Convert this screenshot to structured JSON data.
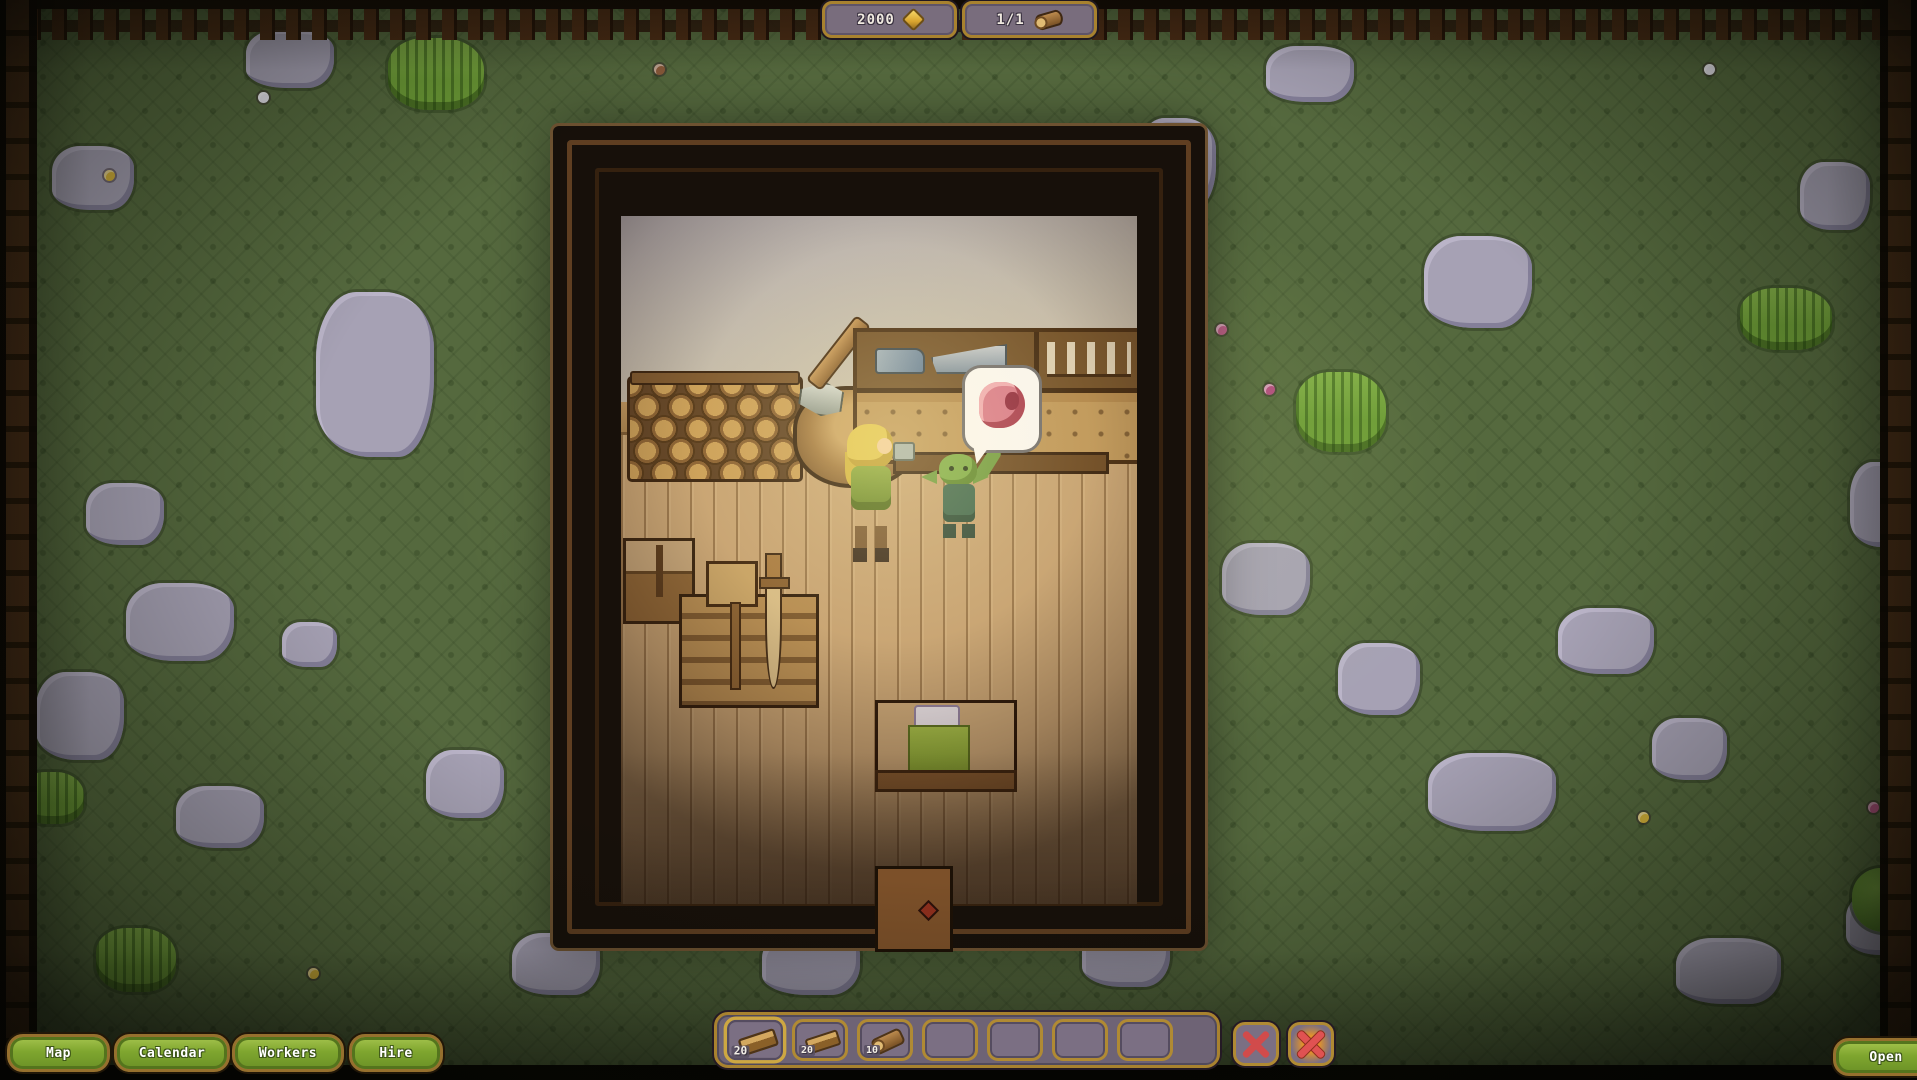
{
  "hud": {
    "money": {
      "value": "2000",
      "icon": "coin-icon"
    },
    "resource": {
      "value": "1/1",
      "icon": "log-icon"
    }
  },
  "menu": {
    "buttons": [
      {
        "label": "Map"
      },
      {
        "label": "Calendar"
      },
      {
        "label": "Workers"
      },
      {
        "label": "Hire"
      }
    ]
  },
  "open_button": {
    "label": "Open"
  },
  "hotbar": {
    "slots": [
      {
        "item": "plank",
        "count": "20",
        "selected": true
      },
      {
        "item": "plank",
        "count": "20"
      },
      {
        "item": "log",
        "count": "10"
      },
      {},
      {},
      {},
      {}
    ],
    "actions": [
      {
        "name": "cancel-slot-button",
        "icon": "red-x-icon"
      },
      {
        "name": "destroy-slot-button",
        "icon": "red-x-burst-icon"
      }
    ]
  },
  "scene": {
    "speech_bubble_icon": "meat-icon",
    "characters": [
      {
        "name": "villager"
      },
      {
        "name": "goblin"
      }
    ],
    "colors": {
      "grass": "#55693e",
      "stone": "#a6a1b4",
      "panel": "#796d7d",
      "gold_border": "#a8822f",
      "button_green": "#7fa62f",
      "x_red": "#d14b4b"
    },
    "decorations": {
      "stones": [
        [
          52,
          146,
          82,
          64
        ],
        [
          246,
          30,
          88,
          58
        ],
        [
          1138,
          118,
          78,
          92
        ],
        [
          1266,
          46,
          88,
          56
        ],
        [
          1424,
          236,
          108,
          92
        ],
        [
          1800,
          162,
          70,
          68
        ],
        [
          1850,
          462,
          66,
          85
        ],
        [
          952,
          438,
          95,
          82
        ],
        [
          1046,
          298,
          68,
          56
        ],
        [
          316,
          292,
          118,
          165
        ],
        [
          86,
          483,
          78,
          62
        ],
        [
          126,
          583,
          108,
          78
        ],
        [
          36,
          672,
          88,
          88
        ],
        [
          176,
          786,
          88,
          62
        ],
        [
          426,
          750,
          78,
          68
        ],
        [
          512,
          933,
          88,
          62
        ],
        [
          762,
          933,
          98,
          62
        ],
        [
          1082,
          923,
          88,
          64
        ],
        [
          1222,
          543,
          88,
          72
        ],
        [
          1338,
          643,
          82,
          72
        ],
        [
          1428,
          753,
          128,
          78
        ],
        [
          1652,
          718,
          75,
          62
        ],
        [
          1676,
          938,
          105,
          66
        ],
        [
          1846,
          893,
          72,
          62
        ],
        [
          696,
          778,
          72,
          58
        ],
        [
          282,
          622,
          55,
          45
        ],
        [
          1558,
          608,
          96,
          66
        ]
      ],
      "tufts": [
        [
          388,
          38,
          96,
          72
        ],
        [
          1076,
          160,
          110,
          145
        ],
        [
          1740,
          288,
          92,
          62
        ],
        [
          1296,
          372,
          90,
          80
        ],
        [
          96,
          928,
          80,
          64
        ],
        [
          20,
          772,
          64,
          52
        ]
      ],
      "bushes": [
        [
          1852,
          868,
          65,
          64
        ]
      ],
      "flowers": [
        {
          "x": 1216,
          "y": 324,
          "c": "#c05a8a"
        },
        {
          "x": 1264,
          "y": 384,
          "c": "#b14a7e"
        },
        {
          "x": 1086,
          "y": 522,
          "c": "#c05a8a"
        },
        {
          "x": 1070,
          "y": 558,
          "c": "#b14a7e"
        },
        {
          "x": 1868,
          "y": 802,
          "c": "#c05a8a"
        },
        {
          "x": 654,
          "y": 64,
          "c": "#8a5a3a"
        },
        {
          "x": 258,
          "y": 92,
          "c": "#e8e6ef"
        },
        {
          "x": 1704,
          "y": 64,
          "c": "#e8e6ef"
        },
        {
          "x": 104,
          "y": 170,
          "c": "#d9b53a"
        },
        {
          "x": 1638,
          "y": 812,
          "c": "#d9b53a"
        },
        {
          "x": 308,
          "y": 968,
          "c": "#d9b53a"
        }
      ]
    }
  }
}
